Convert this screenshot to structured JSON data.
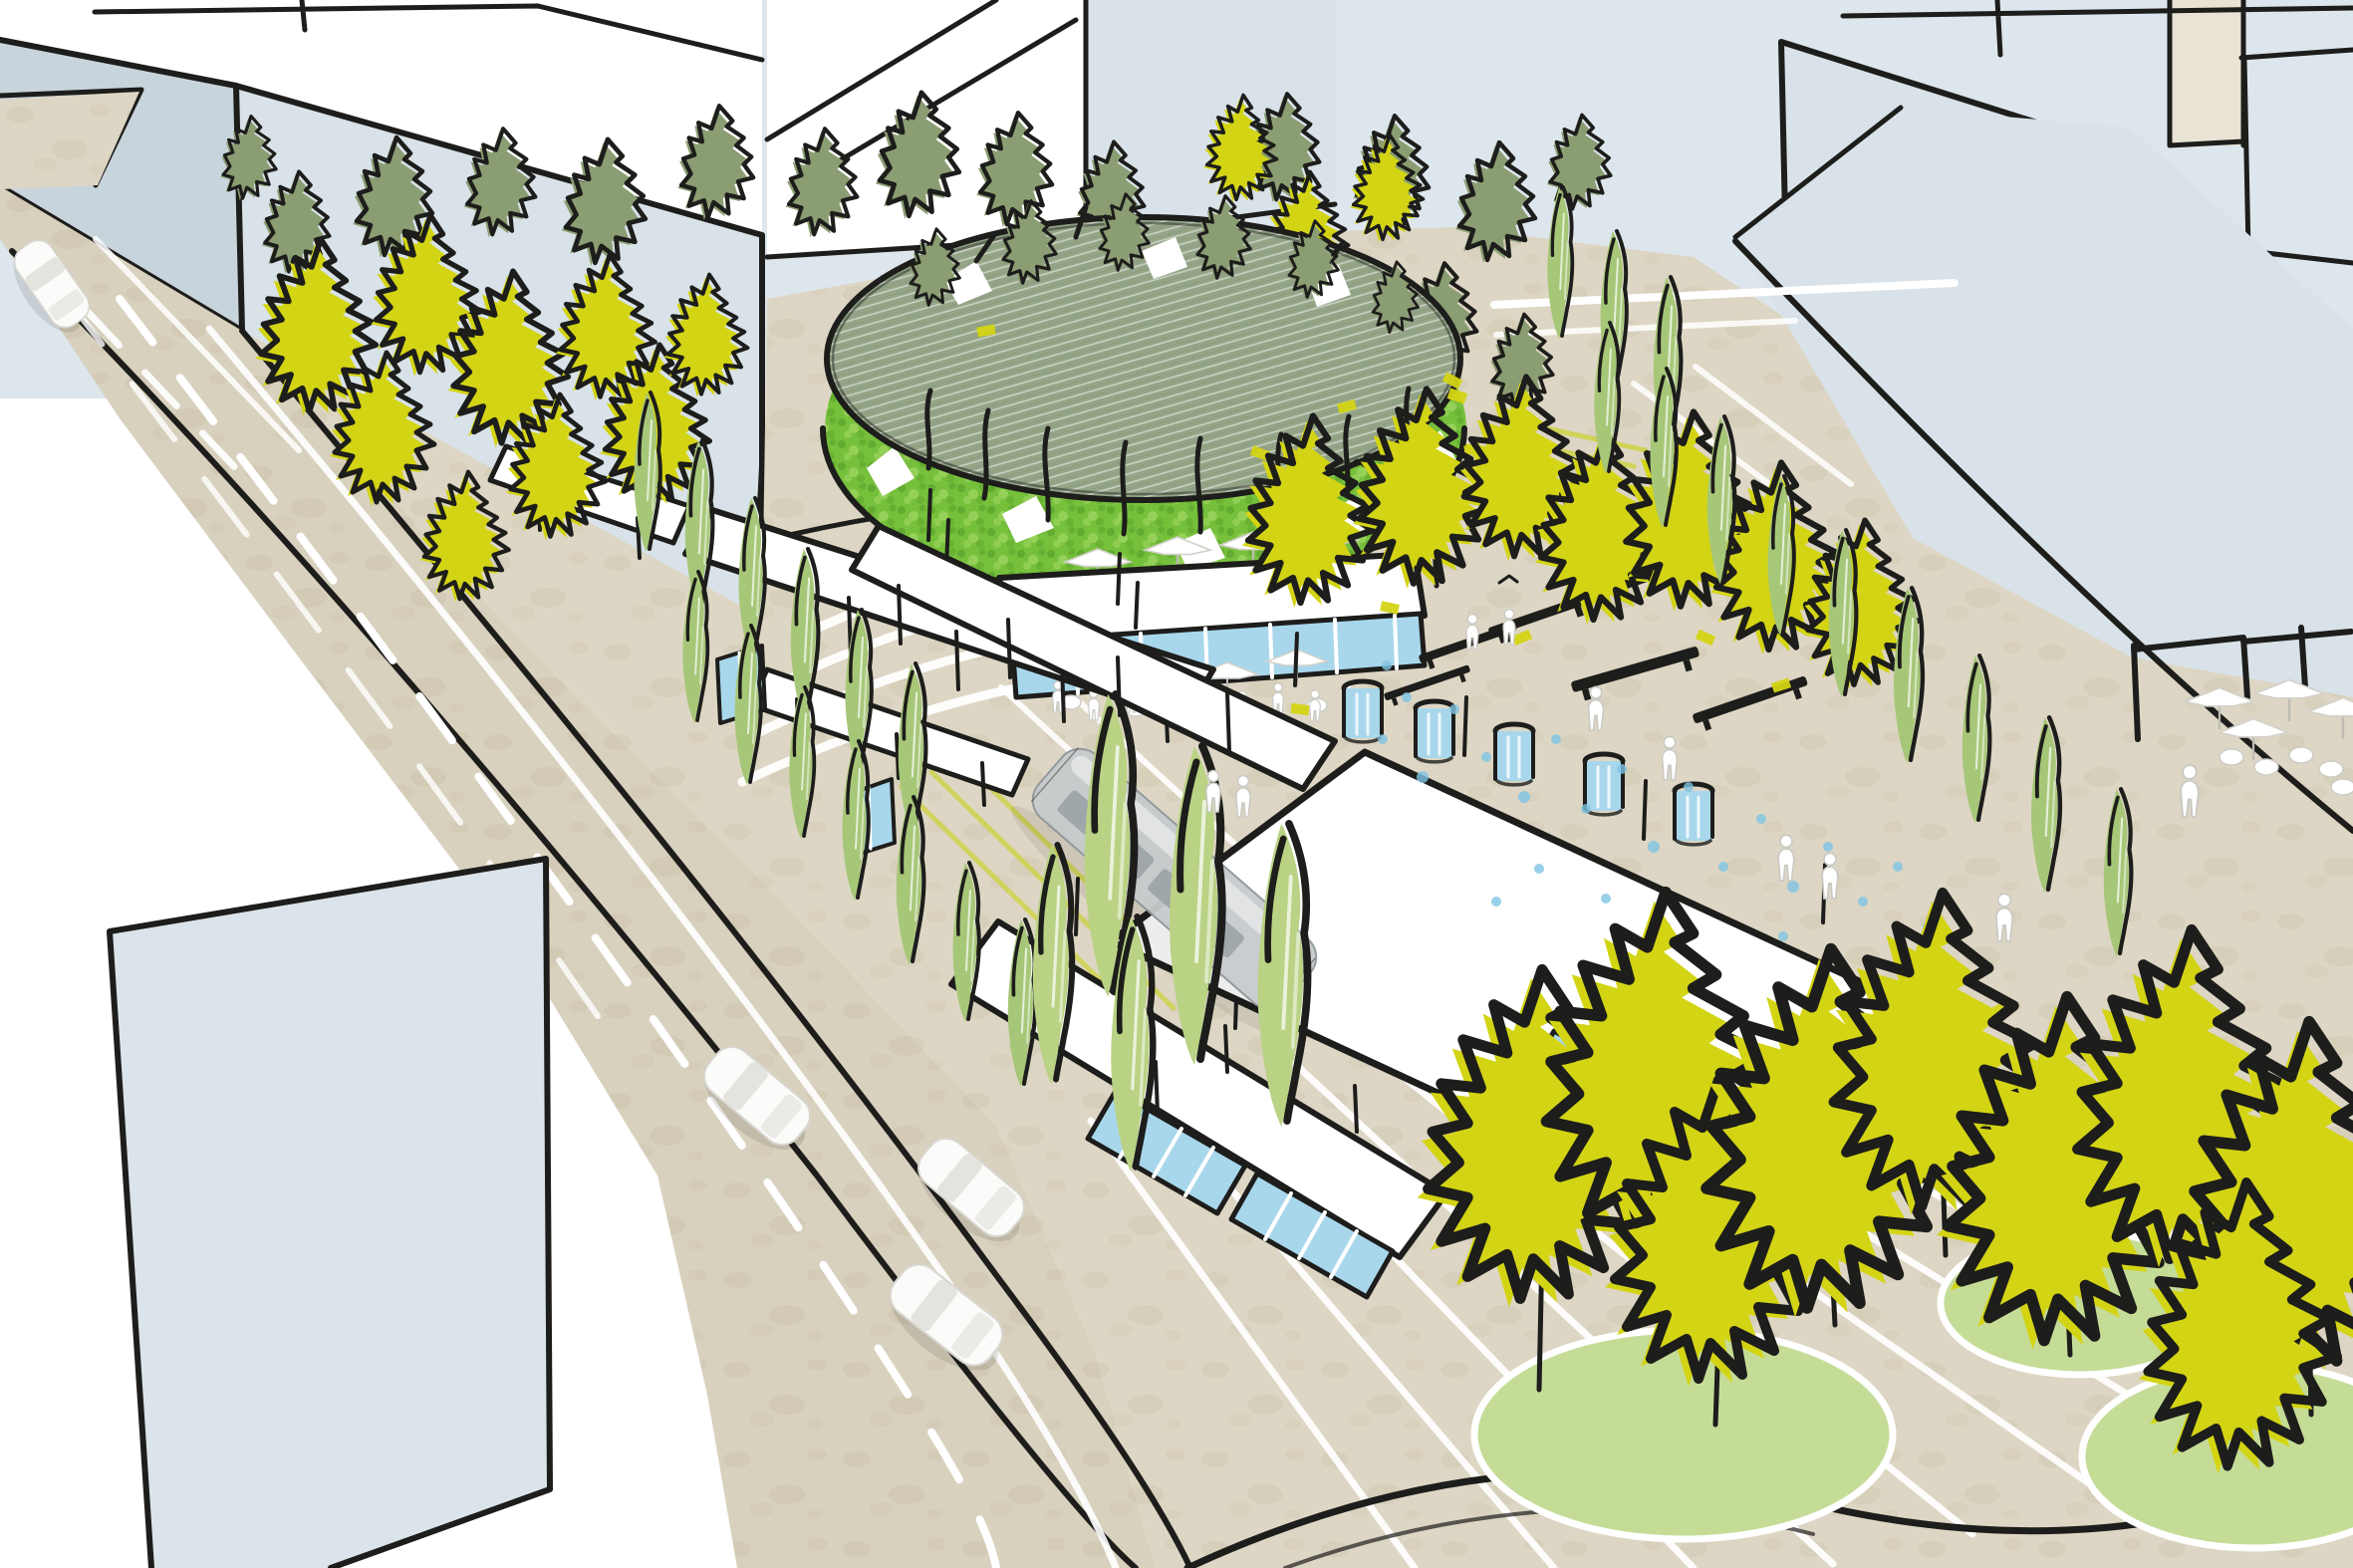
{
  "scene": {
    "type": "hand-drawn urban design perspective sketch",
    "subject": "tram plaza with elevated circular tree-ring structure, glass cafe pavilion, white platform canopies, tree rows, roads with cars and surrounding buildings"
  },
  "palette": {
    "sky": "#dde6ec",
    "paper": "#ffffff",
    "paving": "#ddd6c4",
    "paving_fleck": "#cfc8b2",
    "ink": "#1d1d1b",
    "building_face": "#d8e2e8",
    "building_face_dark": "#c8d4dc",
    "building_beige": "#e9e3d4",
    "tree_chartreuse": "#d3d414",
    "tree_sage": "#a7c778",
    "tree_sage_light": "#b9d284",
    "tree_olive": "#8b9d72",
    "hedge_green": "#76c03c",
    "hedge_green_dark": "#5ba32c",
    "hedge_green_light": "#9ad45d",
    "canopy_gray_green": "#94a487",
    "lawn_green": "#c5dc97",
    "glass_blue": "#a8d7ec",
    "water_blue": "#7fc4e3",
    "tram_gray": "#c7cbcd",
    "tram_gray_light": "#e3e6e7",
    "tram_gray_dark": "#7d868b",
    "car_white": "#fbfbfa",
    "people_white": "#ffffff",
    "people_outline": "#c9c9c4",
    "marking_white": "#ffffff",
    "streak_chartreuse": "#ccd23c"
  },
  "inventory": {
    "tree_ring": 1,
    "ring_cafe_pavilion": 1,
    "platform_canopies": 6,
    "glass_shelters": 6,
    "tram": 1,
    "cars": 4,
    "benches": 6,
    "fountain_columns": 5,
    "spray_dots": 25,
    "lawn_circles": 4,
    "umbrellas": 11,
    "people": 19,
    "cafe_tables": 6,
    "trees_chartreuse_broad": 28,
    "trees_sage_columnar": 30,
    "trees_olive_background": 16,
    "trees_ring_crowns": 6
  }
}
